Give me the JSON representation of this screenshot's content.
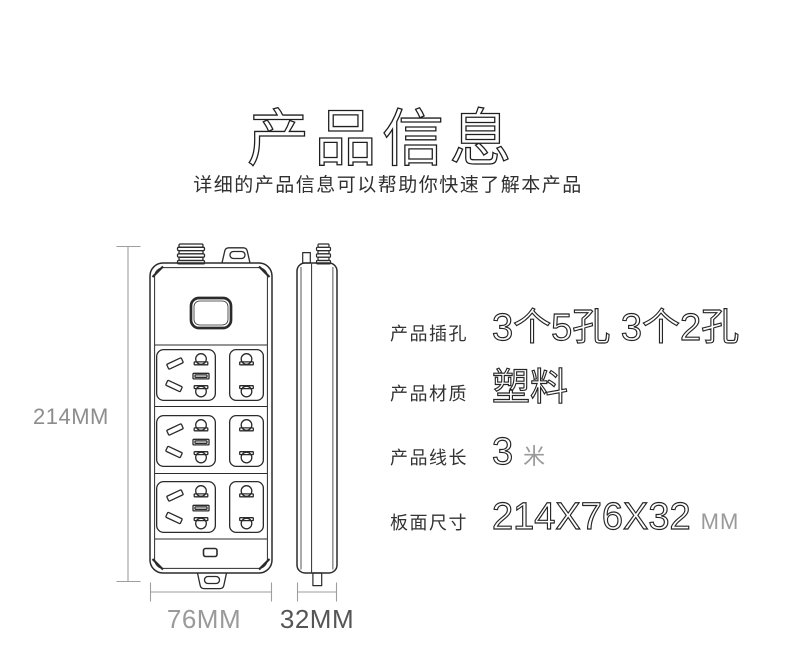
{
  "header": {
    "title": "产品信息",
    "subtitle": "详细的产品信息可以帮助你快速了解本产品"
  },
  "diagram": {
    "height_label": "214MM",
    "width_label": "76MM",
    "depth_label": "32MM"
  },
  "specs": {
    "rows": [
      {
        "label": "产品插孔",
        "value": "3个5孔 3个2孔",
        "suffix": ""
      },
      {
        "label": "产品材质",
        "value": "塑料",
        "suffix": ""
      },
      {
        "label": "产品线长",
        "value": "3",
        "suffix": "米"
      },
      {
        "label": "板面尺寸",
        "value": "214X76X32",
        "suffix": "MM"
      }
    ]
  }
}
